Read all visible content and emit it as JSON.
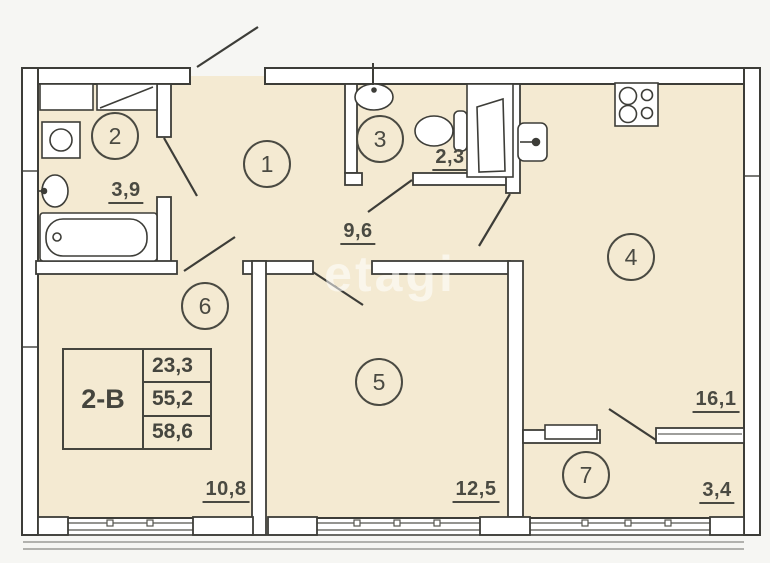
{
  "watermark": "etagi",
  "unit_table": {
    "unit_type": "2-В",
    "values": [
      "23,3",
      "55,2",
      "58,6"
    ]
  },
  "rooms": {
    "hall": {
      "number": "1",
      "area": "9,6"
    },
    "bath": {
      "number": "2",
      "area": "3,9"
    },
    "wc": {
      "number": "3",
      "area": "2,3"
    },
    "kitchen": {
      "number": "4",
      "area": "16,1"
    },
    "room5": {
      "number": "5",
      "area": "12,5"
    },
    "room6": {
      "number": "6",
      "area": "10,8"
    },
    "balcony": {
      "number": "7",
      "area": "3,4"
    }
  },
  "fixtures": [
    "bathtub",
    "bathroom-sink",
    "washing-machine",
    "cabinet",
    "wc-sink",
    "toilet",
    "door-panel",
    "kitchen-sink",
    "stove-4-burner",
    "window-sill"
  ],
  "colors": {
    "background": "#f6f6f3",
    "floor": "#f4ead2",
    "wall_fill": "#ffffff",
    "line": "#3d3d38",
    "label": "#4a4a42",
    "watermark": "rgba(255,255,255,0.55)"
  }
}
